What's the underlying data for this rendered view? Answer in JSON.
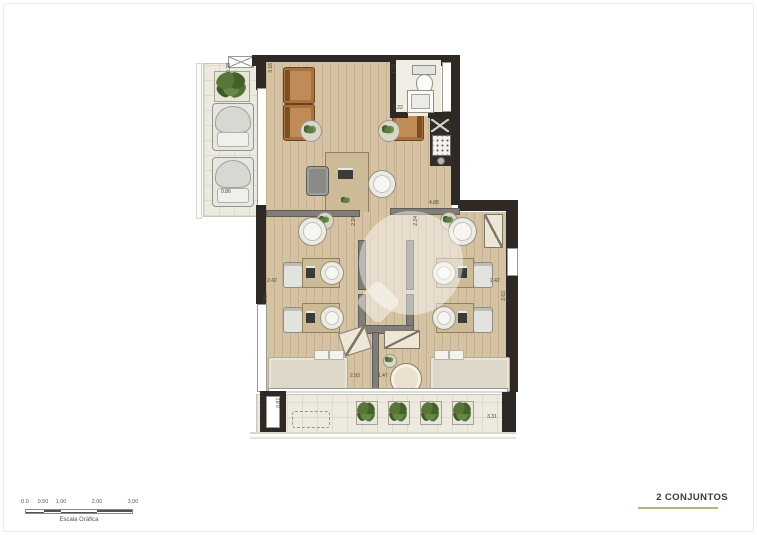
{
  "plan": {
    "dimensions": {
      "terrace_planter": "0.28",
      "terrace_left": "0.86",
      "reception_side": "3.16",
      "wc_side": "1.23",
      "wc_bottom": "1.22",
      "entry_top": "4.88",
      "door_left": "2.24",
      "door_right": "2.24",
      "office_left_w": "2.42",
      "office_left_h": "2.60",
      "office_right_w": "2.42",
      "office_right_h": "2.62",
      "lounge_left": "2.93",
      "lounge_right": "1.47",
      "terrace_bottom_h": "0.87",
      "terrace_bottom_w": "3.31"
    }
  },
  "footer": {
    "title": "2 CONJUNTOS",
    "scale": {
      "caption": "Escala Gráfica",
      "ticks": [
        "0.0",
        "0.50",
        "1.00",
        "2.00",
        "3.00"
      ]
    }
  },
  "colors": {
    "wall": "#2e2925",
    "partition": "#807e77",
    "wood_floor": "#d5c2a2",
    "tile_floor": "#edeae0",
    "armchair": "#a9713f",
    "accent_underline": "#a9b87b"
  }
}
